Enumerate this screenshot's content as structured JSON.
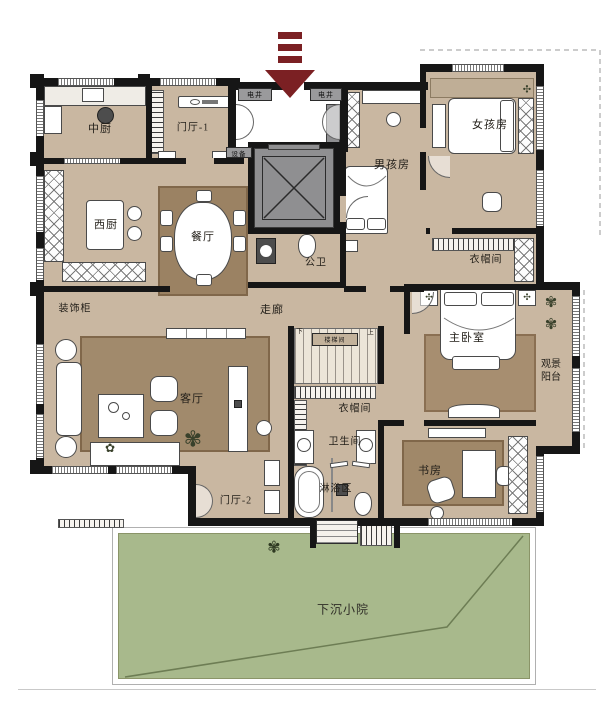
{
  "meta": {
    "kind": "residential floor plan"
  },
  "colors": {
    "floor": "#c9b7a1",
    "wall": "#161616",
    "rug": "#a18a6c",
    "courtyard_green": "#a8b98c",
    "entry_arrow": "#7b2023",
    "elevator_gray": "#8f8f91"
  },
  "rooms": {
    "kitchen_cn": {
      "label": "中厨"
    },
    "foyer1": {
      "label": "门厅-1"
    },
    "shaft_left": {
      "label": "电井"
    },
    "shaft_right": {
      "label": "电井"
    },
    "equipment": {
      "label": "设备"
    },
    "boy_room": {
      "label": "男孩房"
    },
    "girl_room": {
      "label": "女孩房"
    },
    "girl_closet": {
      "label": "衣帽间"
    },
    "kitchen_west": {
      "label": "西厨"
    },
    "dining": {
      "label": "餐厅"
    },
    "public_wc": {
      "label": "公卫"
    },
    "corridor": {
      "label": "走廊"
    },
    "deco_cabinet": {
      "label": "装饰柜"
    },
    "living": {
      "label": "客厅"
    },
    "stairwell": {
      "label": "楼梯间",
      "down": "下",
      "up": "上"
    },
    "mid_closet": {
      "label": "衣帽间"
    },
    "master": {
      "label": "主卧室"
    },
    "balcony": {
      "line1": "观景",
      "line2": "阳台"
    },
    "bathroom": {
      "label": "卫生间"
    },
    "shower": {
      "label": "淋浴区"
    },
    "study": {
      "label": "书房"
    },
    "foyer2": {
      "label": "门厅-2"
    },
    "courtyard": {
      "label": "下沉小院"
    }
  }
}
